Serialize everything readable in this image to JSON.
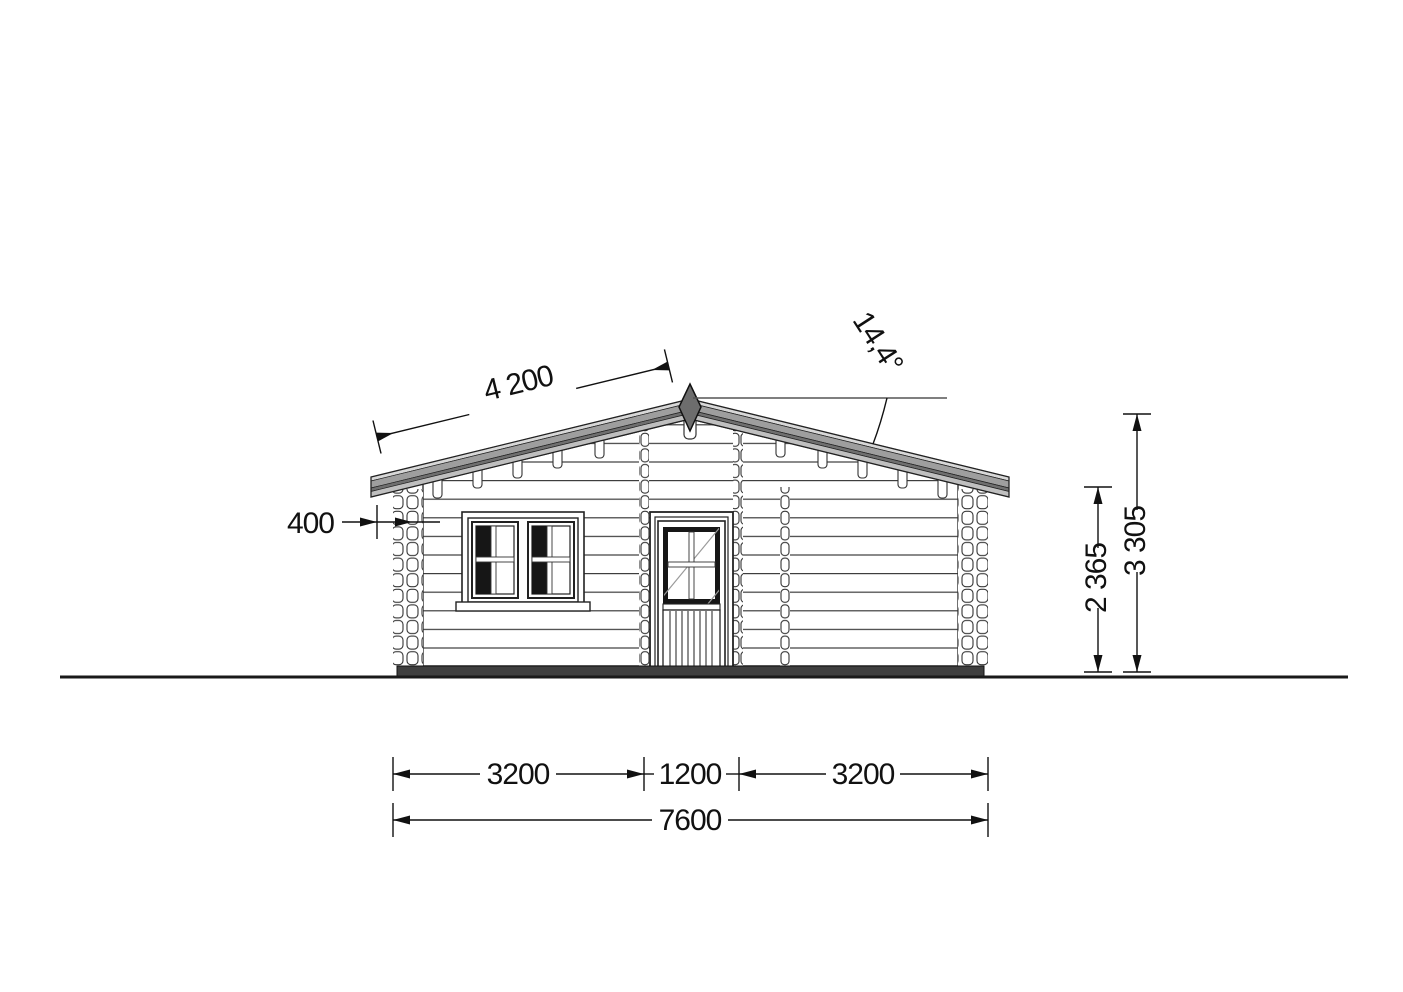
{
  "drawing": {
    "title": "log-cabin-front-elevation"
  },
  "dimensions": {
    "roof_slope_length": "4 200",
    "roof_pitch_angle": "14,4°",
    "eaves_overhang": "400",
    "wall_height": "2 365",
    "ridge_height": "3 305",
    "width_left_section": "3200",
    "width_door_section": "1200",
    "width_right_section": "3200",
    "width_total": "7600"
  },
  "colors": {
    "roof_light": "#d8d8d8",
    "roof_mid": "#9e9e9e",
    "roof_dark": "#6f6f6f",
    "roof_fascia": "#bfbfbf",
    "finial": "#6d6d6d",
    "base_strip": "#3f3f3f",
    "glass_dark": "#161616",
    "line": "#222222"
  }
}
